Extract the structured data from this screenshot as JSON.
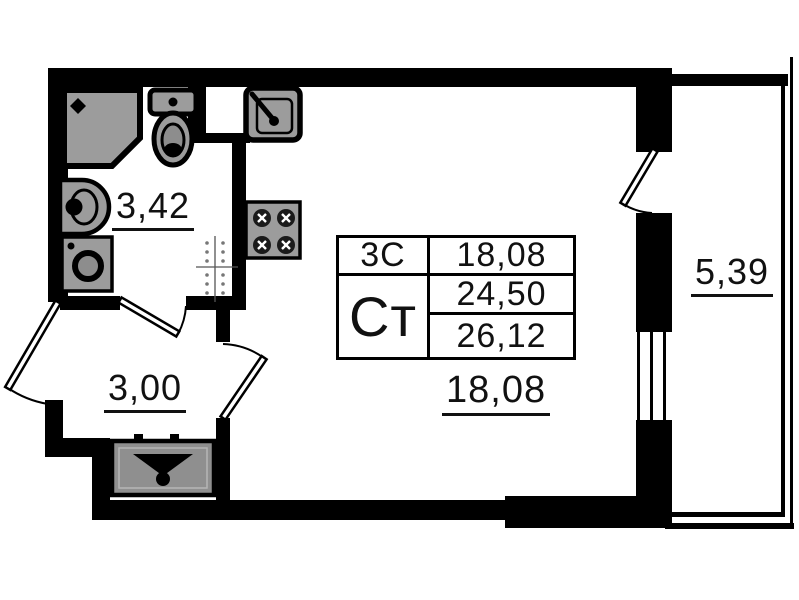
{
  "title": "studio-apartment-floor-plan",
  "colors": {
    "wall": "#000000",
    "fixture_fill": "#9c9c9c",
    "background": "#ffffff"
  },
  "rooms": {
    "bathroom": {
      "area": "3,42"
    },
    "hallway": {
      "area": "3,00"
    },
    "living_room": {
      "area": "18,08"
    },
    "balcony": {
      "area": "5,39"
    }
  },
  "info_table": {
    "rooms_code": "3С",
    "living_area": "18,08",
    "apartment_type": "Ст",
    "area_no_balcony": "24,50",
    "total_area": "26,12"
  },
  "fixtures": [
    "shower-icon",
    "toilet-icon",
    "washbasin-icon",
    "washing-machine-icon",
    "kitchen-sink-icon",
    "stove-icon",
    "ventilation-shaft-icon",
    "wardrobe-icon"
  ]
}
